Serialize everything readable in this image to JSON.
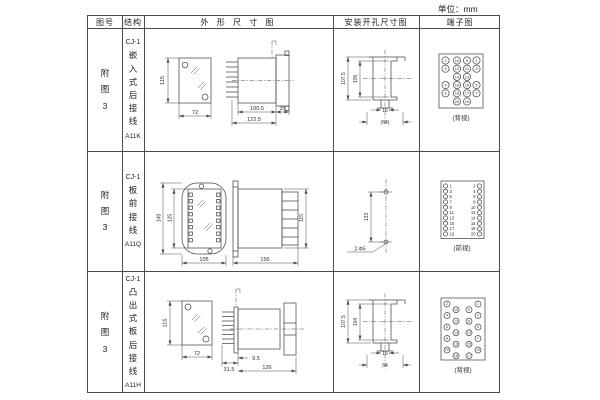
{
  "unit_label": "单位：mm",
  "table": {
    "headers": {
      "figure": "图号",
      "structure": "结构",
      "outline": "外 形 尺 寸 图",
      "mounting": "安装开孔尺寸图",
      "terminal": "端子图"
    },
    "rows": [
      {
        "figure_no": "附图3",
        "series": "CJ-1",
        "structure": "嵌入式后接线",
        "model": "A11K",
        "outline": {
          "front_h": "115",
          "front_w": "72",
          "depth_a": "100.5",
          "depth_b": "122.5",
          "flange": "35"
        },
        "mounting": {
          "outer_h": "107.5",
          "inner_h": "105",
          "notch_w": "16",
          "width": "(64)"
        },
        "terminal": {
          "view_label": "(背视)",
          "pins": [
            "2",
            "10",
            "9",
            "1",
            "4",
            "12",
            "11",
            "3",
            "14",
            "13",
            "6",
            "16",
            "15",
            "5",
            "8",
            "18",
            "17",
            "7",
            "20",
            "19"
          ]
        }
      },
      {
        "figure_no": "附图3",
        "series": "CJ-1",
        "structure": "板前接线",
        "model": "A11Q",
        "outline": {
          "outer_h": "149",
          "inner_h": "125",
          "front_w": "105",
          "depth": "156",
          "side_h": "115"
        },
        "mounting": {
          "hole_span": "133",
          "hole_label": "2-Φ5"
        },
        "terminal": {
          "view_label": "(前视)",
          "left": [
            "1",
            "3",
            "5",
            "7",
            "9",
            "11",
            "13",
            "15",
            "17",
            "19"
          ],
          "right": [
            "2",
            "4",
            "6",
            "8",
            "10",
            "12",
            "14",
            "16",
            "18",
            "20"
          ]
        }
      },
      {
        "figure_no": "附图3",
        "series": "CJ-1",
        "structure": "凸出式板后接线",
        "model": "A11H",
        "outline": {
          "front_h": "115",
          "front_w": "72",
          "depth_a": "31.5",
          "depth_b": "9.5",
          "depth_c": "126"
        },
        "mounting": {
          "outer_h": "107.5",
          "inner_h": "104",
          "notch_w": "16",
          "width": "64"
        },
        "terminal": {
          "view_label": "(背视)",
          "pins": [
            "2",
            "4",
            "6",
            "8",
            "20",
            "10",
            "12",
            "14",
            "16",
            "18",
            "9",
            "11",
            "13",
            "15",
            "17",
            "1",
            "3",
            "5",
            "7",
            "19"
          ]
        }
      }
    ]
  }
}
